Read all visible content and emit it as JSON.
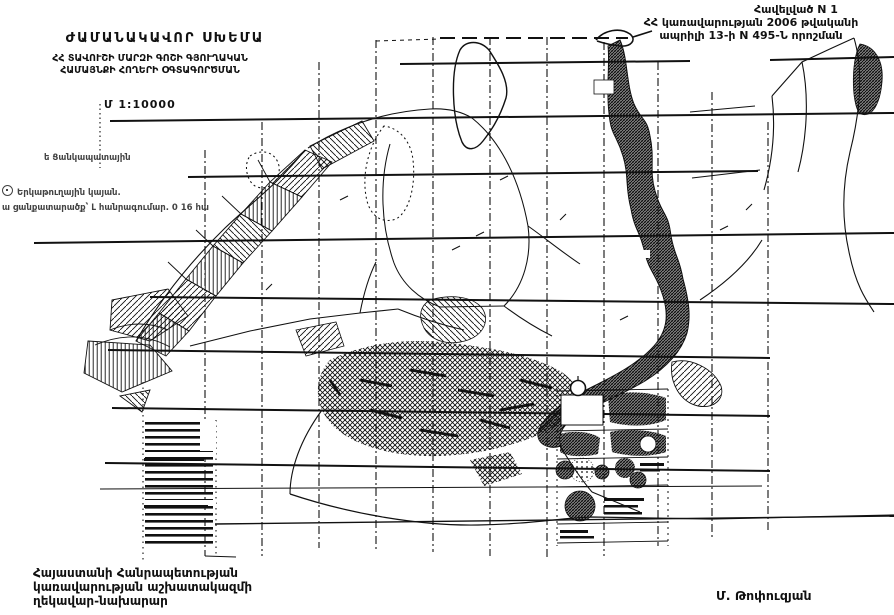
{
  "doc": {
    "annotation": [
      "Հավելված N 1",
      "ՀՀ կառավարության 2006 թվականի",
      "ապրիլի 13-ի N 495-Ն որոշման"
    ],
    "title": "ԺԱՄԱՆԱԿԱՎՈՐ ՍԽԵՄԱ",
    "subtitle": [
      "ՀՀ ՏԱՎՈՒՇԻ ՄԱՐԶԻ ԳՈՇԻ ԳՅՈՒՂԱԿԱՆ",
      "ՀԱՄԱՅՆՔԻ ՀՈՂԵՐԻ ՕԳՏԱԳՈՐԾՄԱՆ"
    ],
    "scale": "Մ 1:10000",
    "legend": {
      "item1": "ե Ցանկապատային",
      "item2": "Երկաթուղային կայան.",
      "item3": "ա ցանքատարածք՝ Լ հանրագումար. 0 16 հա"
    },
    "footer": {
      "office": [
        "Հայաստանի Հանրապետության",
        "կառավարության աշխատակազմի",
        "ղեկավար-նախարար"
      ],
      "signature": "Մ. Թոփուզյան"
    },
    "colors": {
      "ink": "#111111",
      "paper": "#ffffff"
    }
  }
}
